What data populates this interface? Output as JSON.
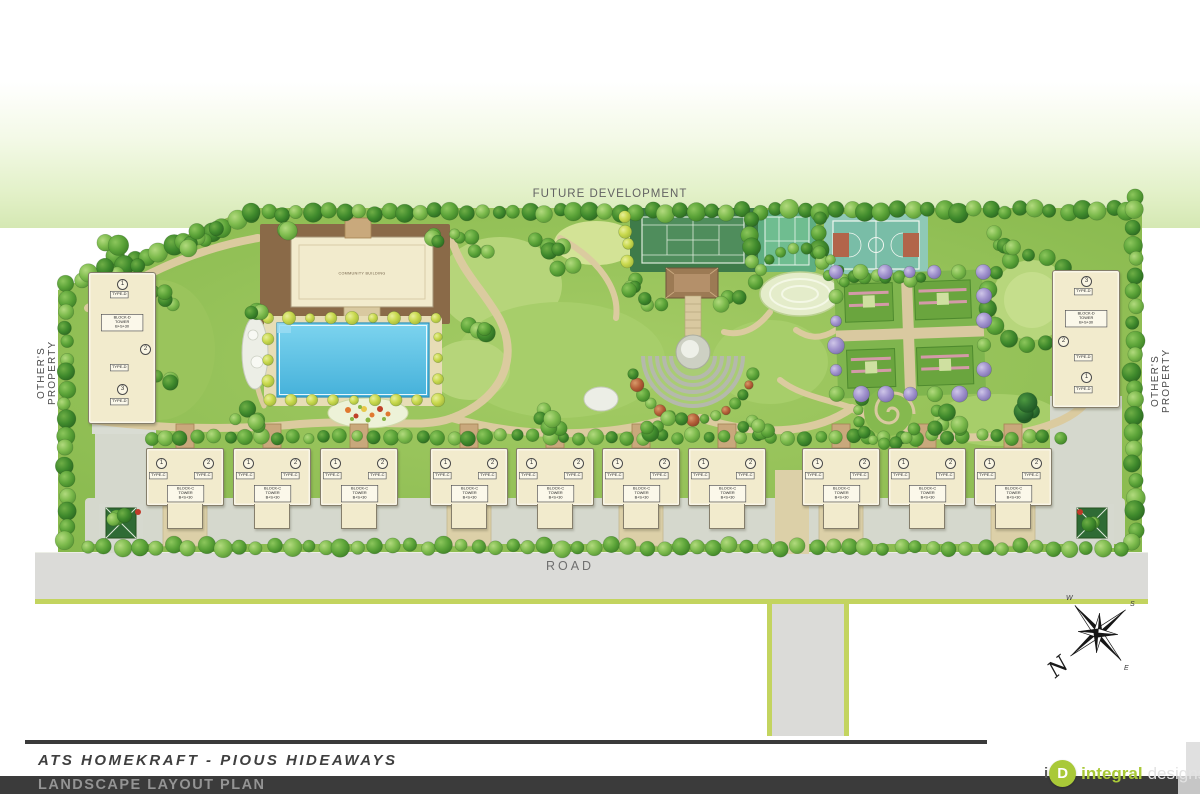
{
  "plan": {
    "future_development_label": "FUTURE DEVELOPMENT",
    "others_property_left": "OTHER'S PROPERTY",
    "others_property_right": "OTHER'S PROPERTY",
    "community_building_label": "COMMUNITY BUILDING",
    "road_label": "ROAD"
  },
  "compass": {
    "n": "N",
    "e": "E",
    "s": "S",
    "w": "W"
  },
  "towers": {
    "row_blocks": [
      {
        "n1": "1",
        "n2": "2",
        "type": "TYPE-C",
        "info_lines": [
          "BLOCK-C",
          "TOWER",
          "B+S+30"
        ]
      },
      {
        "n1": "1",
        "n2": "2",
        "type": "TYPE-C",
        "info_lines": [
          "BLOCK-C",
          "TOWER",
          "B+S+30"
        ]
      },
      {
        "n1": "1",
        "n2": "2",
        "type": "TYPE-C",
        "info_lines": [
          "BLOCK-C",
          "TOWER",
          "B+S+30"
        ]
      },
      {
        "n1": "1",
        "n2": "2",
        "type": "TYPE-C",
        "info_lines": [
          "BLOCK-C",
          "TOWER",
          "B+S+30"
        ]
      },
      {
        "n1": "1",
        "n2": "2",
        "type": "TYPE-C",
        "info_lines": [
          "BLOCK-C",
          "TOWER",
          "B+S+30"
        ]
      },
      {
        "n1": "1",
        "n2": "2",
        "type": "TYPE-C",
        "info_lines": [
          "BLOCK-C",
          "TOWER",
          "B+S+30"
        ]
      },
      {
        "n1": "1",
        "n2": "2",
        "type": "TYPE-C",
        "info_lines": [
          "BLOCK-C",
          "TOWER",
          "B+S+30"
        ]
      },
      {
        "n1": "1",
        "n2": "2",
        "type": "TYPE-C",
        "info_lines": [
          "BLOCK-C",
          "TOWER",
          "B+S+30"
        ]
      },
      {
        "n1": "1",
        "n2": "2",
        "type": "TYPE-C",
        "info_lines": [
          "BLOCK-C",
          "TOWER",
          "B+S+30"
        ]
      },
      {
        "n1": "1",
        "n2": "2",
        "type": "TYPE-C",
        "info_lines": [
          "BLOCK-C",
          "TOWER",
          "B+S+30"
        ]
      }
    ],
    "left_tower": {
      "nums": [
        "1",
        "2",
        "3"
      ],
      "type": "TYPE-D",
      "info_lines": [
        "BLOCK-D",
        "TOWER",
        "B+S+30"
      ]
    },
    "right_tower": {
      "nums": [
        "3",
        "2",
        "1"
      ],
      "type": "TYPE-D",
      "info_lines": [
        "BLOCK-D",
        "TOWER",
        "B+S+30"
      ]
    }
  },
  "footer": {
    "project_title": "ATS HOMEKRAFT - PIOUS HIDEAWAYS",
    "plan_title": "LANDSCAPE LAYOUT PLAN",
    "logo_i": "i",
    "logo_d": "D",
    "logo_name": "integral",
    "logo_suffix": "designs"
  },
  "colors": {
    "field_green": "#8fbe55",
    "pool_blue": "#5fc6e6",
    "path_tan": "#dbcb9f",
    "road_gray": "#dbdbd8",
    "road_edge_green": "#c3d45f",
    "tennis_court_green": "#4f8d5c",
    "multipurpose_court_teal": "#6fbd90",
    "basketball_teal": "#79bda7",
    "terracotta": "#b2654a",
    "building_cream": "#f2ebcd",
    "deck_brown": "#8a6a48",
    "purple_tree": "#a395cf",
    "title_bar": "#3b3b3b",
    "logo_green": "#a9c938"
  }
}
